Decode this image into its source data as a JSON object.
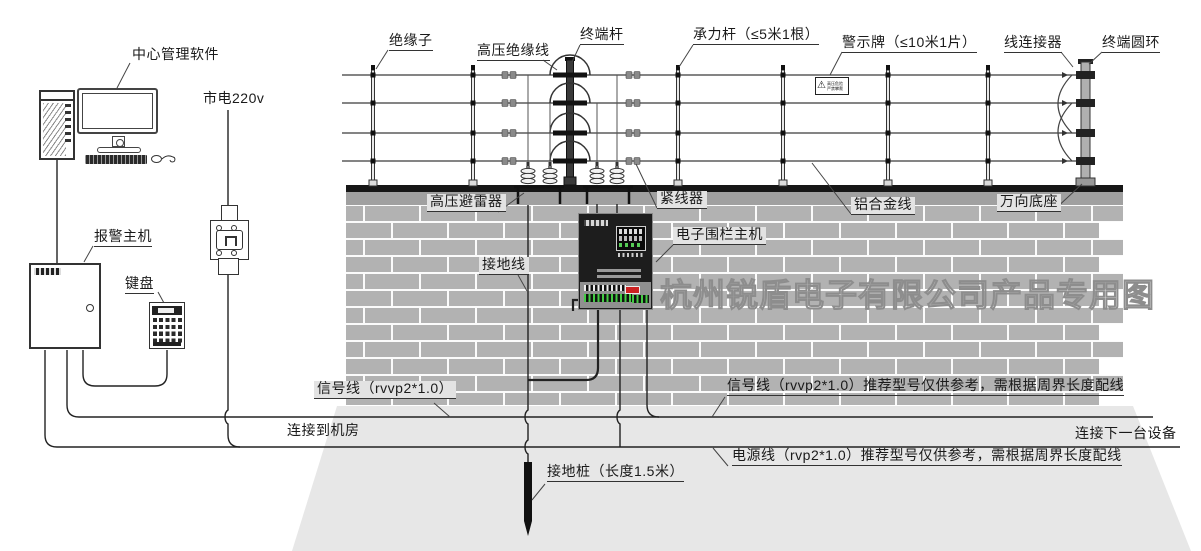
{
  "watermark": "杭州锐盾电子有限公司产品专用图",
  "labels": {
    "center_software": "中心管理软件",
    "mains": "市电220v",
    "alarm_host": "报警主机",
    "keypad": "键盘",
    "insulator": "绝缘子",
    "hv_insulated_wire": "高压绝缘线",
    "terminal_pole": "终端杆",
    "load_pole": "承力杆（≤5米1根）",
    "warning_sign": "警示牌（≤10米1片）",
    "wire_connector": "线连接器",
    "terminal_ring": "终端圆环",
    "hv_arrester": "高压避雷器",
    "wire_tensioner": "紧线器",
    "alloy_wire": "铝合金线",
    "universal_base": "万向底座",
    "fence_host": "电子围栏主机",
    "ground_wire": "接地线",
    "signal_wire_left": "信号线（rvvp2*1.0）",
    "connect_room": "连接到机房",
    "signal_wire_right": "信号线（rvvp2*1.0）推荐型号仅供参考，需根据周界长度配线",
    "connect_next": "连接下一台设备",
    "power_wire": "电源线（rvp2*1.0）推荐型号仅供参考，需根据周界长度配线",
    "ground_stake": "接地桩（长度1.5米）"
  },
  "sign": {
    "line1": "高压危险",
    "line2": "严禁攀爬"
  }
}
